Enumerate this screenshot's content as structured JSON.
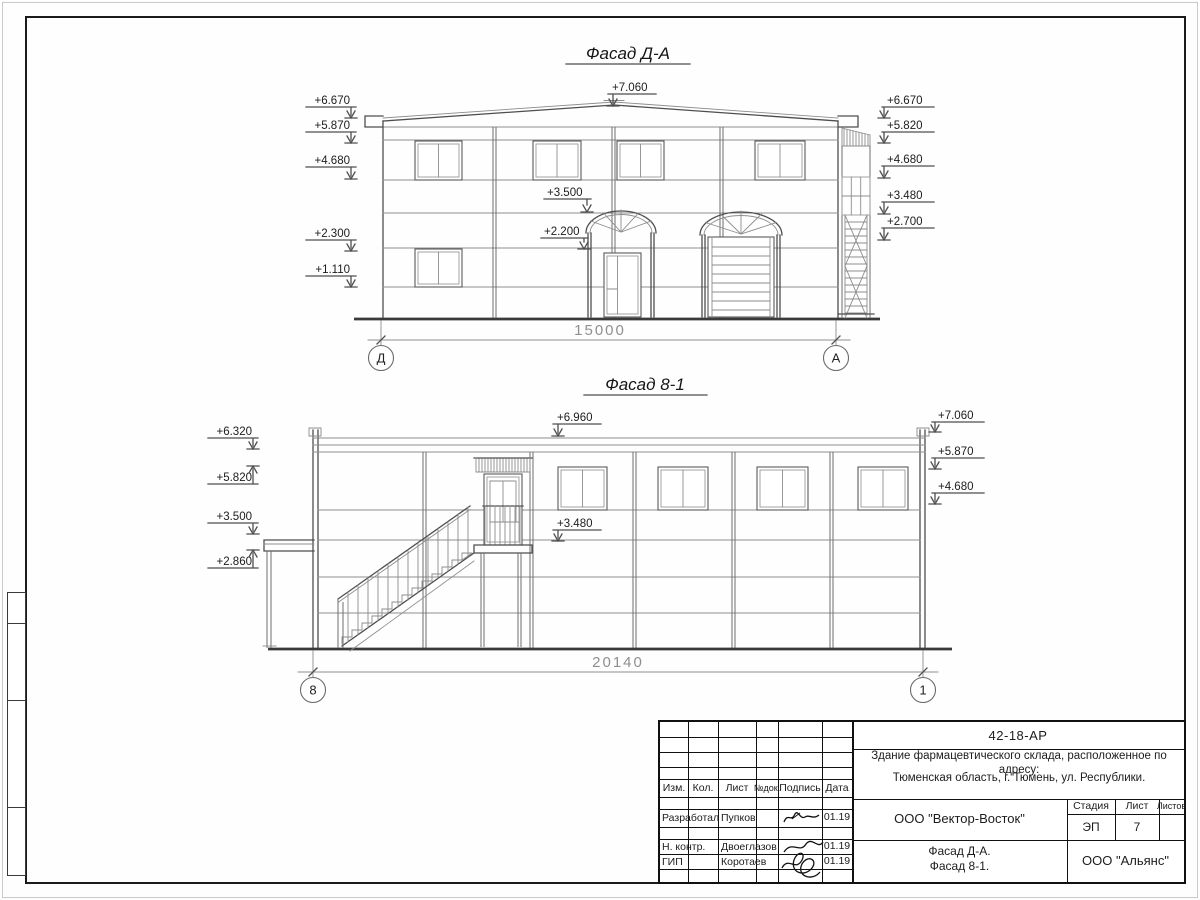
{
  "facade_da": {
    "title": "Фасад Д-А",
    "dimension": "15000",
    "axis_left": "Д",
    "axis_right": "А",
    "marks_left": [
      "+6.670",
      "+5.870",
      "+4.680",
      "+2.300",
      "+1.110"
    ],
    "marks_center": [
      "+7.060",
      "+3.500",
      "+2.200"
    ],
    "marks_right": [
      "+6.670",
      "+5.820",
      "+4.680",
      "+3.480",
      "+2.700"
    ]
  },
  "facade_81": {
    "title": "Фасад 8-1",
    "dimension": "20140",
    "axis_left": "8",
    "axis_right": "1",
    "marks_left": [
      "+6.320",
      "+5.820",
      "+3.500",
      "+2.860"
    ],
    "marks_center": [
      "+6.960",
      "+3.480"
    ],
    "marks_right": [
      "+7.060",
      "+5.870",
      "+4.680"
    ]
  },
  "title_block": {
    "doc_number": "42-18-АР",
    "description_line1": "Здание фармацевтического склада, расположенное по адресу:",
    "description_line2": "Тюменская область, г. Тюмень, ул. Республики.",
    "contractor": "ООО \"Вектор-Восток\"",
    "client": "ООО \"Альянс\"",
    "sheet_title_line1": "Фасад Д-А.",
    "sheet_title_line2": "Фасад 8-1.",
    "stage_label": "Стадия",
    "stage_value": "ЭП",
    "sheet_label": "Лист",
    "sheet_value": "7",
    "sheets_label": "Листов",
    "sheets_value": "",
    "columns": [
      "Изм.",
      "Кол.",
      "Лист",
      "№док.",
      "Подпись",
      "Дата"
    ],
    "rows": [
      {
        "role": "Разработал",
        "name": "Пупков",
        "date": "01.19"
      },
      {
        "role": "Н. контр.",
        "name": "Двоеглазов",
        "date": "01.19"
      },
      {
        "role": "ГИП",
        "name": "Коротаев",
        "date": "01.19"
      }
    ]
  }
}
